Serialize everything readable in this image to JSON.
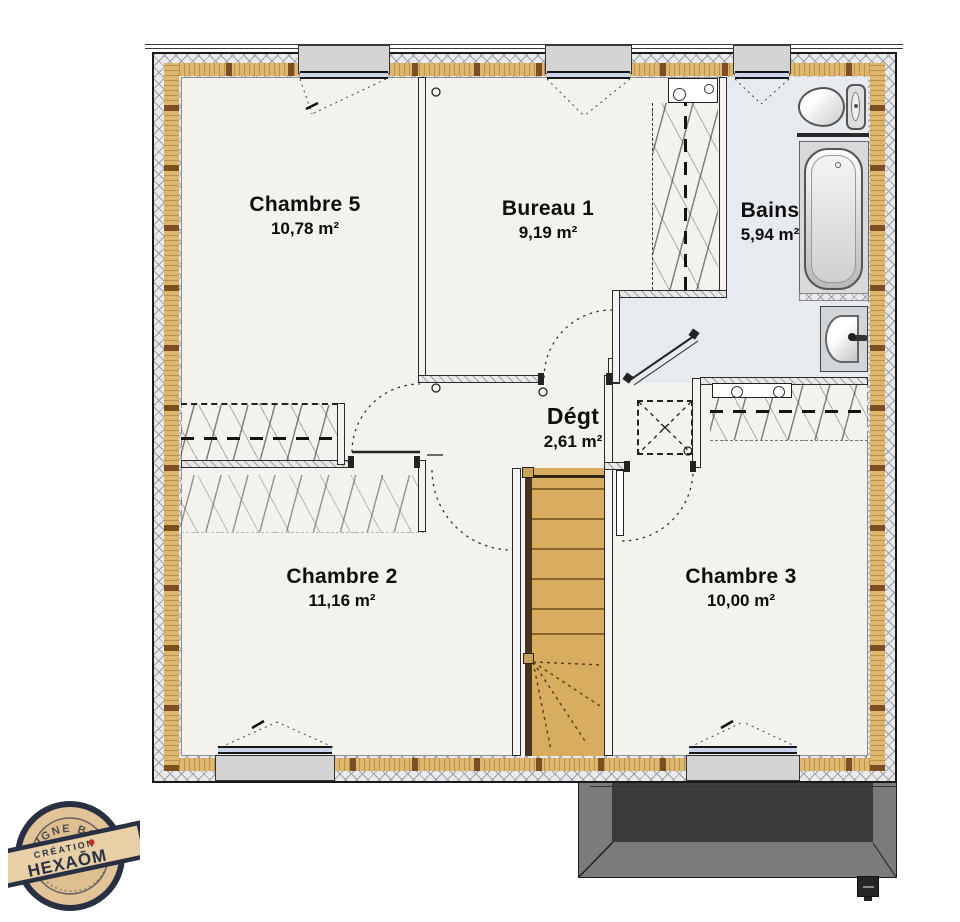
{
  "rooms": [
    {
      "name": "Chambre 5",
      "area": "10,78 m²"
    },
    {
      "name": "Bureau 1",
      "area": "9,19 m²"
    },
    {
      "name": "Bains",
      "area": "5,94 m²"
    },
    {
      "name": "Dégt",
      "area": "2,61 m²"
    },
    {
      "name": "Chambre 2",
      "area": "11,16 m²"
    },
    {
      "name": "Chambre 3",
      "area": "10,00 m²"
    }
  ],
  "stamp": {
    "arc_text": "LIGNE BOIS",
    "banner_small": "CRÉATION",
    "banner_brand": "HEXAŌM"
  },
  "icons": {
    "toilet": "toilet-icon",
    "bathtub": "bathtub-icon",
    "sink": "sink-icon",
    "skylight": "skylight-icon",
    "stairs": "stairs-icon"
  },
  "colors": {
    "floor": "#f3f2ed",
    "bath_floor": "#e7eaee",
    "wall_wood": "#dcb76d",
    "wall_wood_divider": "#7d4e21",
    "stair_wood": "#d8ad60",
    "roof_dark": "#3c3c3c",
    "roof_mid": "#7b7b7b",
    "stamp_navy": "#2a3044",
    "stamp_red": "#c63228",
    "stamp_wood": "#e3c498"
  }
}
